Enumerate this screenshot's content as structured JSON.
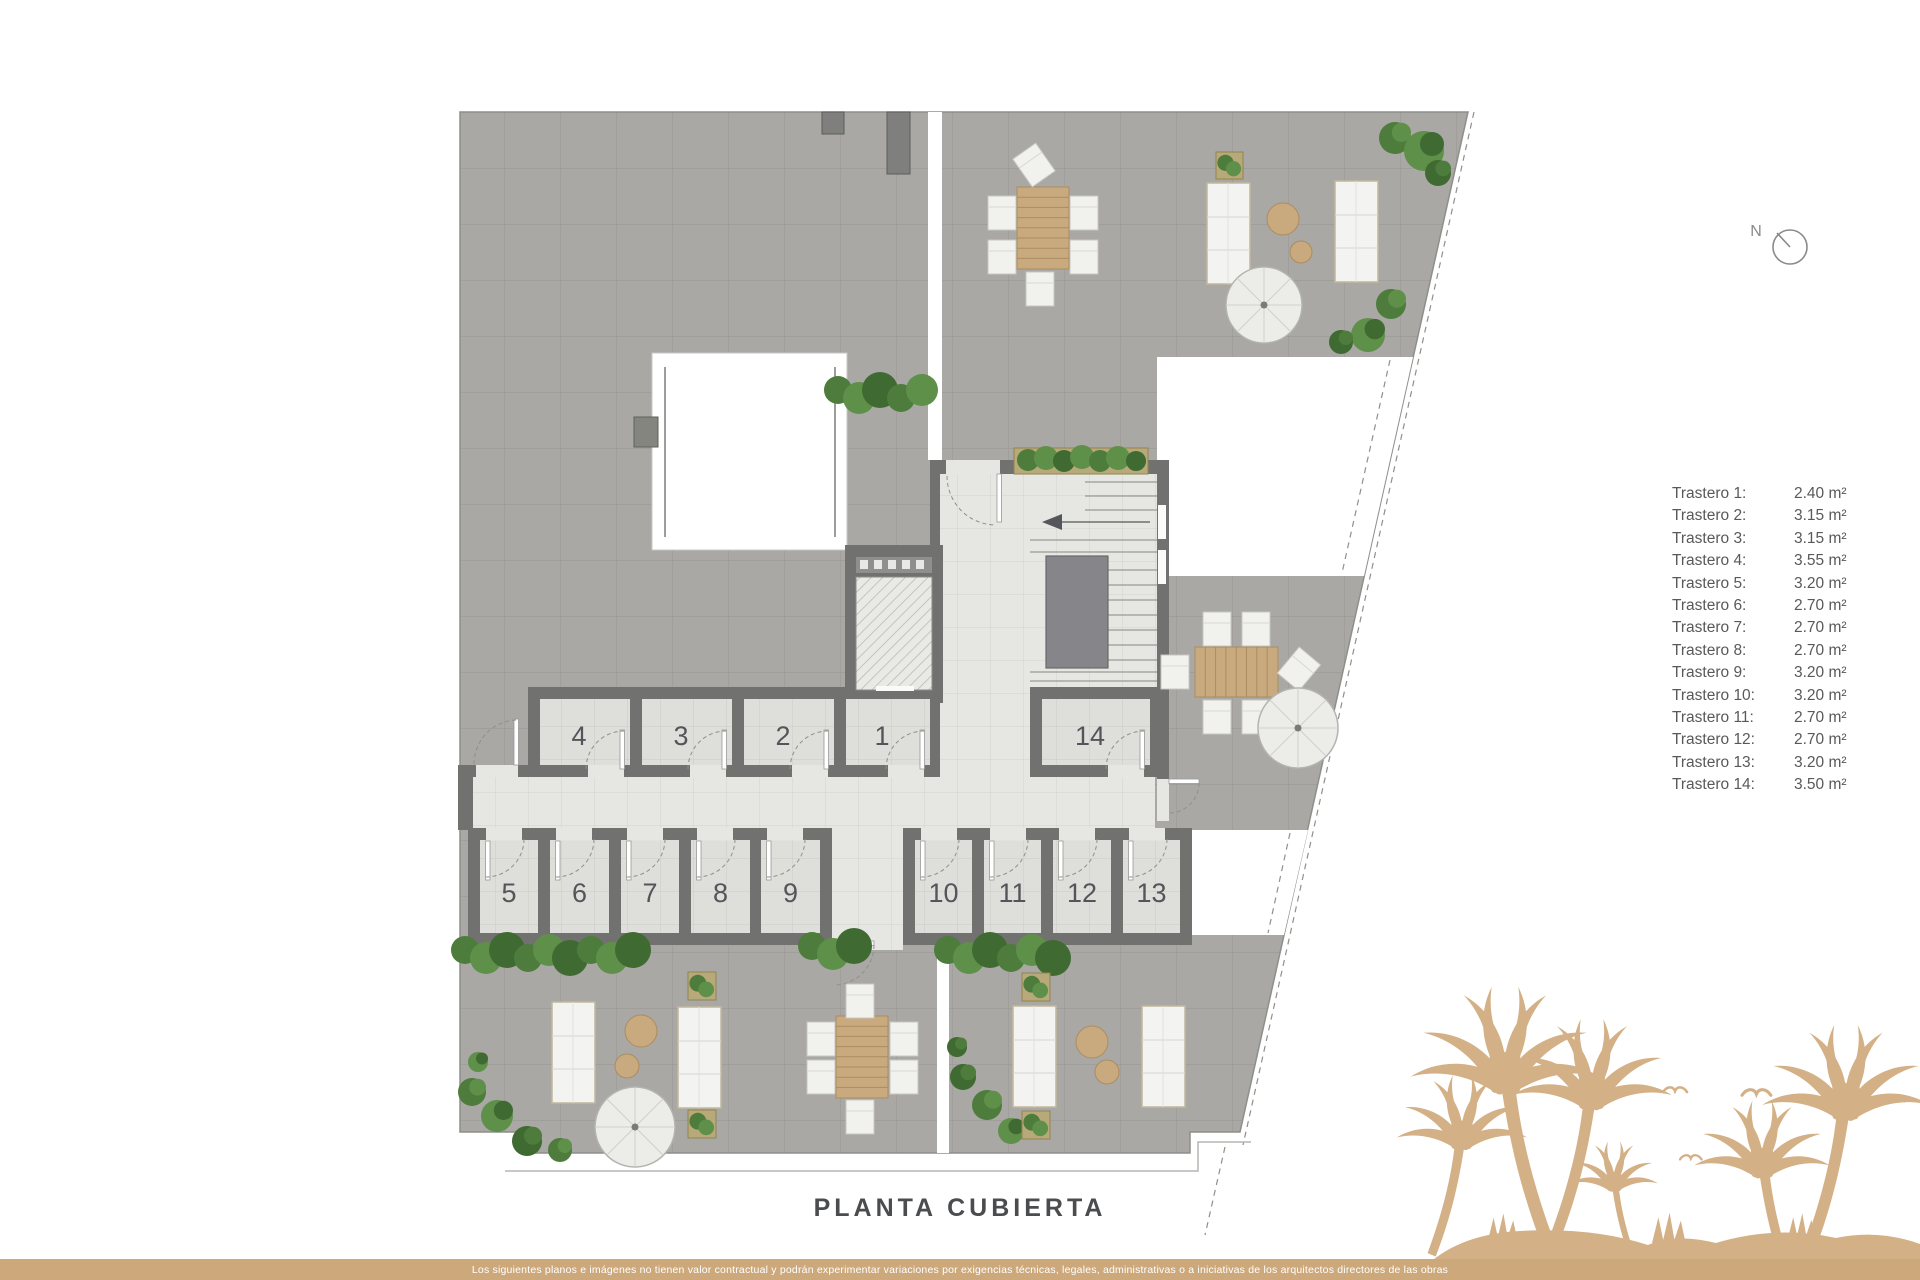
{
  "title": "PLANTA CUBIERTA",
  "north": {
    "label": "N"
  },
  "plan": {
    "rooms": [
      "4",
      "3",
      "2",
      "1",
      "14",
      "5",
      "6",
      "7",
      "8",
      "9",
      "10",
      "11",
      "12",
      "13"
    ]
  },
  "legend": {
    "items": [
      {
        "label": "Trastero 1:",
        "value": "2.40 m²"
      },
      {
        "label": "Trastero 2:",
        "value": "3.15 m²"
      },
      {
        "label": "Trastero 3:",
        "value": "3.15 m²"
      },
      {
        "label": "Trastero 4:",
        "value": "3.55 m²"
      },
      {
        "label": "Trastero 5:",
        "value": "3.20 m²"
      },
      {
        "label": "Trastero 6:",
        "value": "2.70 m²"
      },
      {
        "label": "Trastero 7:",
        "value": "2.70 m²"
      },
      {
        "label": "Trastero 8:",
        "value": "2.70 m²"
      },
      {
        "label": "Trastero 9:",
        "value": "3.20 m²"
      },
      {
        "label": "Trastero 10:",
        "value": "3.20 m²"
      },
      {
        "label": "Trastero 11:",
        "value": "2.70 m²"
      },
      {
        "label": "Trastero 12:",
        "value": "2.70 m²"
      },
      {
        "label": "Trastero 13:",
        "value": "3.20 m²"
      },
      {
        "label": "Trastero 14:",
        "value": "3.50 m²"
      }
    ]
  },
  "footer": {
    "disclaimer": "Los siguientes planos e imágenes no tienen valor contractual y podrán experimentar variaciones por exigencias técnicas, legales, administrativas o a iniciativas de los arquitectos directores de las obras"
  },
  "colors": {
    "gold_footer": "#cda87b",
    "gold_palm": "#d3b086",
    "terrace_tile": "#a9a8a4",
    "interior_floor": "#e6e6e2",
    "wall": "#717170",
    "plant_green": "#4d7c3c",
    "wood": "#c9aa7e",
    "legend_text": "#58595b",
    "title_text": "#4b4c4e"
  }
}
